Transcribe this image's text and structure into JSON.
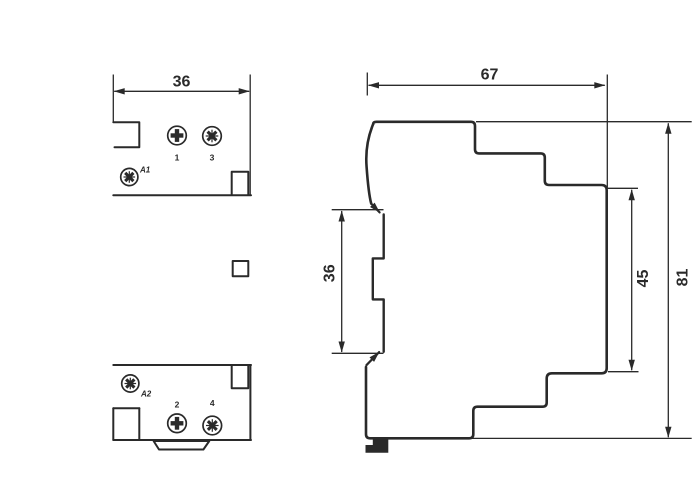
{
  "drawing": {
    "type": "technical-dimension-drawing",
    "front": {
      "width_dim": "36",
      "terminal_top_left": "1",
      "terminal_top_right": "3",
      "terminal_bottom_left": "2",
      "terminal_bottom_right": "4",
      "coil_top": "A1",
      "coil_bottom": "A2"
    },
    "side": {
      "depth_dim": "67",
      "rail_dim": "36",
      "step_dim": "45",
      "height_dim": "81"
    },
    "icons": {
      "phillips_screw": "+",
      "pozidriv_screw": "✻"
    },
    "colors": {
      "line_color": "#2a2a2a",
      "background": "#ffffff"
    }
  }
}
